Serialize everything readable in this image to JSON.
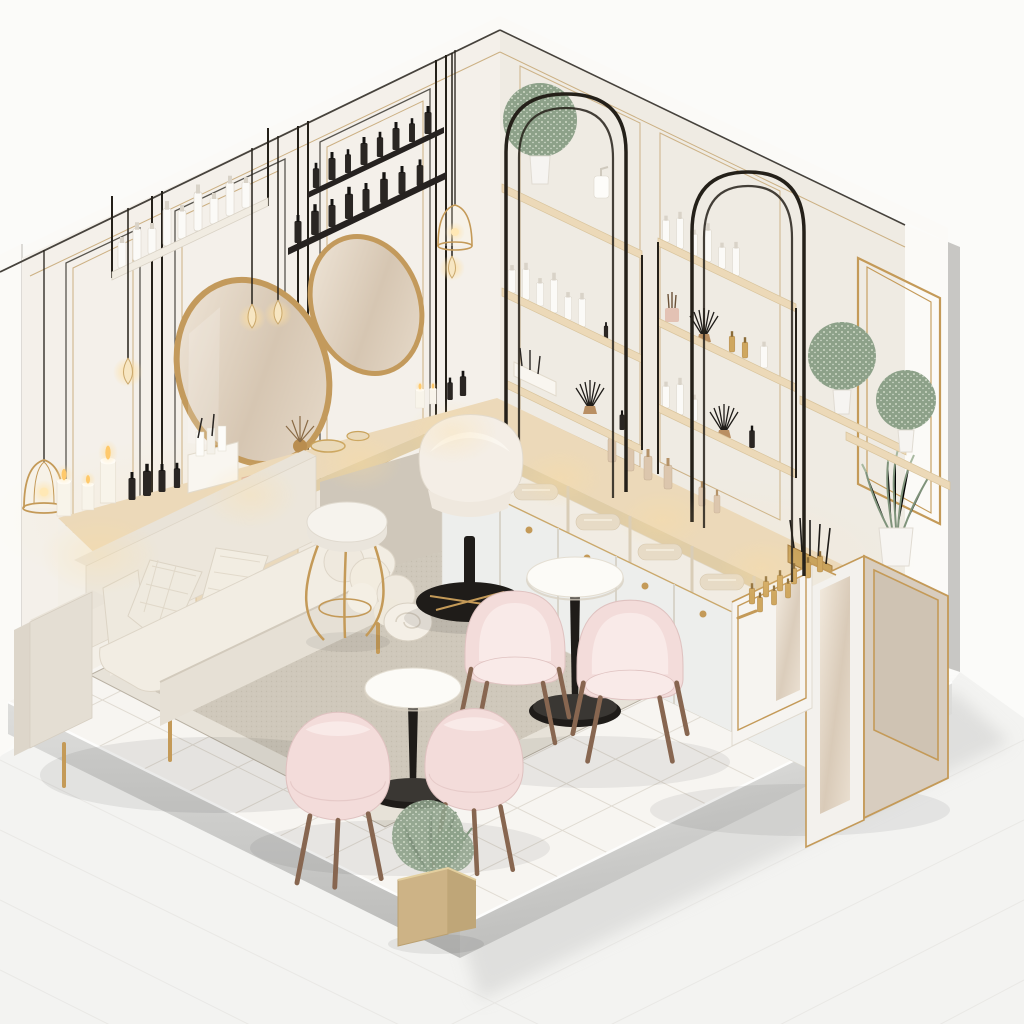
{
  "scene": {
    "description": "Isometric 3D render of a small beauty / nail salon interior diorama with two white walls, a tiled floor platform, an L-shaped vanity counter, product shelving, mirrors, plants and a pastel seating area",
    "style": "soft cream, blush pink, gold and black accents"
  },
  "palette": {
    "bg": "#fbfbf9",
    "ground": "#f3f3f1",
    "wallLeft": "#f4f0ea",
    "wallRight": "#efebe3",
    "wallBand": "#fbfaf7",
    "wallEdge": "#c8c7c4",
    "floor": "#f7f5f1",
    "tileLine": "#e0dbd2",
    "extTileLine": "#e9e8e5",
    "platformLight": "#d8d8d6",
    "platformDark": "#bdbdbb",
    "rug": "#cfc8bb",
    "rugBorder": "#e7e2d8",
    "wood": "#ecd9b9",
    "woodEdge": "#e0cda7",
    "cabinet": "#edeeec",
    "taupe": "#d8cdbf",
    "metal": "#242019",
    "gold": "#c49a58",
    "goldDark": "#a87f42",
    "sofa": "#e9e3d8",
    "sofaLight": "#f2ede3",
    "pink": "#f3dcda",
    "pinkLight": "#f9eae8",
    "pinkShade": "#dfc2c0",
    "chairLeg": "#876650",
    "cream": "#f4eee6",
    "plant": "#8da189",
    "plantLight": "#d4decb",
    "candle": "#f8f4ea",
    "flame": "#ffc96b",
    "glow": "#ffdf9e",
    "baseBlack": "#1f1c19",
    "beige": "#dcc6ad",
    "towel": "#e7dbc6"
  },
  "objects": {
    "scene": "salon interior diorama",
    "left_wall": "left wall with black and gold trim panels",
    "right_wall": "right wall with gold picture frame",
    "floor": "white tiled floor platform",
    "rug": "textured greige area rug",
    "sofa": "cream loveseat sofa with gold legs, two patterned pillows and rolled throw",
    "vanity_desk": "wooden vanity desk with candles, nail polish and gold trays",
    "counter_cabinets": "counter run with towel cubbies and white doors with gold knobs",
    "reception_cabinet": "gold-trimmed reception display cabinet with gold polish bottles",
    "mirror_1": "large round gold-rim wall mirror",
    "mirror_2": "small round gold-rim wall mirror",
    "shelf_white_products": "white wall shelf with white cosmetic bottles",
    "shelf_black_products": "black wall shelves with black cosmetic bottles",
    "arch_stand_1": "black arched display stand with wood shelves and topiary",
    "arch_stand_2": "black arched display stand with brushes and bottles",
    "wall_frame": "gold rectangular frame on right wall",
    "topiary_shelves": "wood shelves with two ball topiaries in white pots",
    "lavender_pot": "white pot with lavender sprigs on counter",
    "planter_box": "gold cube planter with baby's-breath plant",
    "bistro_table_1": "round white bistro table with black pedestal",
    "bistro_table_2": "round white bistro table with black pedestal",
    "armchair_1": "blush pink tub chair with wooden legs",
    "armchair_2": "blush pink tub chair with wooden legs",
    "armchair_3": "blush pink tub chair with wooden legs",
    "armchair_4": "blush pink tub chair with wooden legs",
    "swivel_chair": "cream tub swivel chair with black star base",
    "stool": "round white stool with curved gold legs",
    "pendant_bulbs": "hanging filament teardrop bulbs",
    "cage_lanterns": "gold birdcage pendant lanterns",
    "candles": "lit pillar candles along the vanity",
    "step_candleholder": "gold stepped candle holder",
    "towels": "rolled towels in open cubbies",
    "counts": {
      "armchairs": 4,
      "tables": 2,
      "mirrors": 2,
      "ball_topiaries": 3,
      "arch_stands": 2,
      "cage_lanterns": 2
    }
  }
}
